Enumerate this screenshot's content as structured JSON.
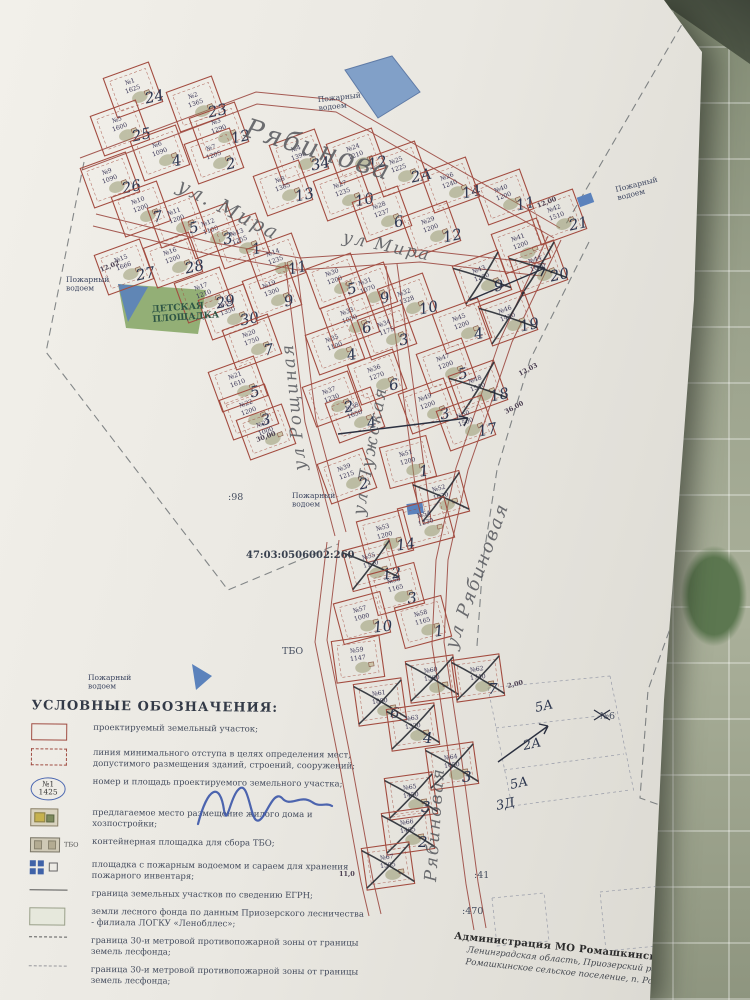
{
  "map": {
    "cadastral_number": "47:03:0506002:260",
    "plots": [
      {
        "n": 1,
        "a": "1625",
        "h": "24",
        "x": 133,
        "y": 90
      },
      {
        "n": 2,
        "a": "1365",
        "h": "23",
        "x": 196,
        "y": 104
      },
      {
        "n": 3,
        "a": "1290",
        "h": "12",
        "x": 219,
        "y": 130
      },
      {
        "n": 4,
        "a": "1390",
        "h": "34",
        "x": 299,
        "y": 157
      },
      {
        "n": 5,
        "a": "1600",
        "h": "25",
        "x": 120,
        "y": 128
      },
      {
        "n": 6,
        "a": "1090",
        "h": "4",
        "x": 160,
        "y": 153
      },
      {
        "n": 7,
        "a": "1205",
        "h": "2",
        "x": 214,
        "y": 156
      },
      {
        "n": 8,
        "a": "1385",
        "h": "13",
        "x": 283,
        "y": 188
      },
      {
        "n": 9,
        "a": "1090",
        "h": "26",
        "x": 110,
        "y": 180
      },
      {
        "n": 10,
        "a": "1200",
        "h": "7",
        "x": 141,
        "y": 209
      },
      {
        "n": 11,
        "a": "1200",
        "h": "5",
        "x": 177,
        "y": 220
      },
      {
        "n": 12,
        "a": "1100",
        "h": "3",
        "x": 211,
        "y": 231
      },
      {
        "n": 13,
        "a": "1255",
        "h": "1",
        "x": 240,
        "y": 241
      },
      {
        "n": 14,
        "a": "1235",
        "h": "11",
        "x": 276,
        "y": 261
      },
      {
        "n": 15,
        "a": "1666",
        "h": "27",
        "x": 124,
        "y": 267
      },
      {
        "n": 16,
        "a": "1200",
        "h": "28",
        "x": 173,
        "y": 260
      },
      {
        "n": 17,
        "a": "1210",
        "h": "29",
        "x": 204,
        "y": 295
      },
      {
        "n": 18,
        "a": "1350",
        "h": "30",
        "x": 228,
        "y": 312
      },
      {
        "n": 19,
        "a": "1300",
        "h": "9",
        "x": 272,
        "y": 293
      },
      {
        "n": 20,
        "a": "1750",
        "h": "7",
        "x": 252,
        "y": 342
      },
      {
        "n": 21,
        "a": "1610",
        "h": "5",
        "x": 238,
        "y": 384
      },
      {
        "n": 22,
        "a": "1200",
        "h": "3",
        "x": 249,
        "y": 412
      },
      {
        "n": 23,
        "a": "1000",
        "h": "",
        "x": 266,
        "y": 432
      },
      {
        "n": 24,
        "a": "1210",
        "h": "12",
        "x": 356,
        "y": 156
      },
      {
        "n": 25,
        "a": "1225",
        "h": "2А",
        "x": 399,
        "y": 169
      },
      {
        "n": 26,
        "a": "1240",
        "h": "14",
        "x": 450,
        "y": 185
      },
      {
        "n": 27,
        "a": "1235",
        "h": "10",
        "x": 343,
        "y": 193
      },
      {
        "n": 28,
        "a": "1237",
        "h": "6",
        "x": 382,
        "y": 214
      },
      {
        "n": 29,
        "a": "1200",
        "h": "12",
        "x": 431,
        "y": 229
      },
      {
        "n": 30,
        "a": "1200",
        "h": "5",
        "x": 335,
        "y": 281
      },
      {
        "n": 31,
        "a": "1070",
        "h": "9",
        "x": 368,
        "y": 290
      },
      {
        "n": 32,
        "a": "1328",
        "h": "10",
        "x": 407,
        "y": 301
      },
      {
        "n": 33,
        "a": "1050",
        "h": "6",
        "x": 350,
        "y": 320
      },
      {
        "n": 34,
        "a": "1175",
        "h": "3",
        "x": 387,
        "y": 332
      },
      {
        "n": 35,
        "a": "1100",
        "h": "4",
        "x": 335,
        "y": 347
      },
      {
        "n": 36,
        "a": "1270",
        "h": "6",
        "x": 377,
        "y": 377
      },
      {
        "n": 37,
        "a": "1230",
        "h": "2",
        "x": 332,
        "y": 399
      },
      {
        "n": 38,
        "a": "1650",
        "h": "4",
        "x": 355,
        "y": 415
      },
      {
        "n": 39,
        "a": "1215",
        "h": "2",
        "x": 347,
        "y": 476
      },
      {
        "n": 40,
        "a": "1200",
        "h": "11",
        "x": 504,
        "y": 197
      },
      {
        "n": 41,
        "a": "1200",
        "h": "",
        "x": 521,
        "y": 246
      },
      {
        "n": 42,
        "a": "1510",
        "h": "21",
        "x": 557,
        "y": 217
      },
      {
        "n": 43,
        "a": "1200",
        "h": "9",
        "x": 482,
        "y": 278,
        "c": true
      },
      {
        "n": 44,
        "a": "1600",
        "h": "20",
        "x": 538,
        "y": 268,
        "c": true
      },
      {
        "n": 45,
        "a": "1200",
        "h": "4",
        "x": 462,
        "y": 326
      },
      {
        "n": 46,
        "a": "1450",
        "h": "19",
        "x": 508,
        "y": 318,
        "c": true
      },
      {
        "n": 47,
        "a": "1200",
        "h": "5",
        "x": 446,
        "y": 366
      },
      {
        "n": 48,
        "a": "1540",
        "h": "18",
        "x": 478,
        "y": 388,
        "c": true
      },
      {
        "n": 49,
        "a": "1200",
        "h": "3",
        "x": 428,
        "y": 406
      },
      {
        "n": 50,
        "a": "1500",
        "h": "17",
        "x": 466,
        "y": 423
      },
      {
        "n": 51,
        "a": "1200",
        "h": "1",
        "x": 408,
        "y": 462,
        "r": -15
      },
      {
        "n": 52,
        "a": "1620",
        "h": "",
        "x": 441,
        "y": 497,
        "r": -15,
        "c": true
      },
      {
        "n": 53,
        "a": "1200",
        "h": "14",
        "x": 385,
        "y": 536,
        "r": -15
      },
      {
        "n": 54,
        "a": "1230",
        "h": "",
        "x": 426,
        "y": 523,
        "r": -15
      },
      {
        "n": 55,
        "a": "1120",
        "h": "12",
        "x": 371,
        "y": 565,
        "r": -15,
        "c": true
      },
      {
        "n": 56,
        "a": "1165",
        "h": "3",
        "x": 396,
        "y": 589,
        "r": -15
      },
      {
        "n": 57,
        "a": "1000",
        "h": "10",
        "x": 362,
        "y": 618,
        "r": -15
      },
      {
        "n": 58,
        "a": "1165",
        "h": "1",
        "x": 423,
        "y": 622,
        "r": -15
      },
      {
        "n": 59,
        "a": "1147",
        "h": "",
        "x": 358,
        "y": 659,
        "r": -8
      },
      {
        "n": 60,
        "a": "1560",
        "h": "",
        "x": 432,
        "y": 679,
        "r": -8,
        "c": true
      },
      {
        "n": 61,
        "a": "1880",
        "h": "6",
        "x": 380,
        "y": 702,
        "r": -8,
        "c": true
      },
      {
        "n": 62,
        "a": "1740",
        "h": "7",
        "x": 478,
        "y": 678,
        "r": -8,
        "c": true
      },
      {
        "n": 63,
        "a": "1320",
        "h": "4",
        "x": 413,
        "y": 727,
        "r": -8,
        "c": true
      },
      {
        "n": 64,
        "a": "1650",
        "h": "3",
        "x": 452,
        "y": 766,
        "r": -8,
        "c": true
      },
      {
        "n": 65,
        "a": "1450",
        "h": "3",
        "x": 411,
        "y": 796,
        "r": -8,
        "c": true
      },
      {
        "n": 66,
        "a": "1465",
        "h": "2",
        "x": 408,
        "y": 831,
        "r": -8,
        "c": true
      },
      {
        "n": 67,
        "a": "1505",
        "h": "",
        "x": 388,
        "y": 866,
        "r": -8,
        "c": true
      }
    ],
    "streets": [
      {
        "text": "Рябинова",
        "x": 243,
        "y": 136,
        "rot": 17,
        "size": 27
      },
      {
        "text": "ул. Мира",
        "x": 176,
        "y": 190,
        "rot": 27,
        "size": 20
      },
      {
        "text": "ул Мира",
        "x": 342,
        "y": 242,
        "rot": 12,
        "size": 17
      },
      {
        "text": "ул Рощиная",
        "x": 306,
        "y": 470,
        "rot": -96,
        "size": 17
      },
      {
        "text": "ул Лужская",
        "x": 364,
        "y": 516,
        "rot": -80,
        "size": 17
      },
      {
        "text": "ул Рябиновая",
        "x": 456,
        "y": 650,
        "rot": -70,
        "size": 18
      },
      {
        "text": "Рябиновая",
        "x": 436,
        "y": 882,
        "rot": -86,
        "size": 17
      }
    ],
    "labels": [
      {
        "t": "Пожарный\nводоем",
        "x": 66,
        "y": 282,
        "rot": 0,
        "cls": "lbl"
      },
      {
        "t": "Пожарный\nводоем",
        "x": 318,
        "y": 102,
        "rot": -6,
        "cls": "lbl"
      },
      {
        "t": "Пожарный\nводоем",
        "x": 616,
        "y": 192,
        "rot": -14,
        "cls": "lbl"
      },
      {
        "t": "Пожарный\nводоем",
        "x": 292,
        "y": 498,
        "rot": 0,
        "cls": "lbl"
      },
      {
        "t": "Пожарный\nводоем",
        "x": 88,
        "y": 680,
        "rot": 0,
        "cls": "lbl"
      },
      {
        "t": "ДЕТСКАЯ\nПЛОЩАДКА",
        "x": 152,
        "y": 312,
        "rot": -4,
        "cls": "lbl-play"
      },
      {
        "t": "ТБО",
        "x": 282,
        "y": 654,
        "rot": 0,
        "cls": "lbl-big"
      },
      {
        "t": ":98",
        "x": 228,
        "y": 500,
        "rot": 0,
        "cls": "lbl-big"
      },
      {
        "t": ":41",
        "x": 474,
        "y": 878,
        "rot": 0,
        "cls": "lbl-big"
      },
      {
        "t": ":470",
        "x": 462,
        "y": 914,
        "rot": 0,
        "cls": "lbl-big"
      },
      {
        "t": "№6",
        "x": 600,
        "y": 719,
        "rot": 0,
        "cls": "lbl-big"
      },
      {
        "t": "47:03:0506002:260",
        "x": 246,
        "y": 558,
        "rot": 0,
        "cls": "lbl-cad"
      }
    ],
    "measures": [
      {
        "t": "12,00",
        "x": 538,
        "y": 208,
        "rot": -22
      },
      {
        "t": "12,02",
        "x": 101,
        "y": 272,
        "rot": -22
      },
      {
        "t": "12,03",
        "x": 520,
        "y": 376,
        "rot": -28
      },
      {
        "t": "36,00",
        "x": 506,
        "y": 414,
        "rot": -28
      },
      {
        "t": "30,00",
        "x": 257,
        "y": 442,
        "rot": -20
      },
      {
        "t": "2,00",
        "x": 508,
        "y": 688,
        "rot": -14
      },
      {
        "t": "11,0",
        "x": 339,
        "y": 876,
        "rot": 0
      }
    ],
    "right_parcels": [
      {
        "t": "5А",
        "x": 536,
        "y": 712
      },
      {
        "t": "2А",
        "x": 524,
        "y": 750
      },
      {
        "t": "5А",
        "x": 511,
        "y": 789
      },
      {
        "t": "3Д",
        "x": 497,
        "y": 810
      }
    ]
  },
  "legend": {
    "title": "УСЛОВНЫЕ ОБОЗНАЧЕНИЯ:",
    "sample_number": "№1",
    "sample_area": "1425",
    "tbo_label": "ТБО",
    "items": [
      {
        "sym": "plot",
        "text": "проектируемый земельный участок;"
      },
      {
        "sym": "setback",
        "text": "линия минимального отступа в целях определения мест, допустимого размещения зданий, строений, сооружений;"
      },
      {
        "sym": "number",
        "text": "номер и площадь проектируемого земельного участка;"
      },
      {
        "sym": "house",
        "text": "предлагаемое место размещение жилого дома и хозпостройки;"
      },
      {
        "sym": "tbo",
        "text": "контейнерная площадка для сбора ТБО;"
      },
      {
        "sym": "fire",
        "text": "площадка с пожарным водоемом и сараем для хранения пожарного инвентаря;"
      },
      {
        "sym": "egrn",
        "text": "граница земельных участков по сведению ЕГРН;"
      },
      {
        "sym": "forest",
        "text": "земли лесного фонда по данным Приозерского лесничества - филиала ЛОГКУ «Ленобллес»;"
      },
      {
        "sym": "zone30",
        "text": "граница 30-и метровой противопожарной зоны от границы земель лесфонда;"
      },
      {
        "sym": "zone30b",
        "text": "граница 30-и метровой противопожарной зоны от границы земель лесфонда;"
      }
    ]
  },
  "title_block": {
    "line1": "Администрация МО Ромашкинское сельское поселе",
    "line2": "Ленинградская область,  Приозерский район,",
    "line3": "Ромашкинское сельское поселение,  п. Рома"
  }
}
